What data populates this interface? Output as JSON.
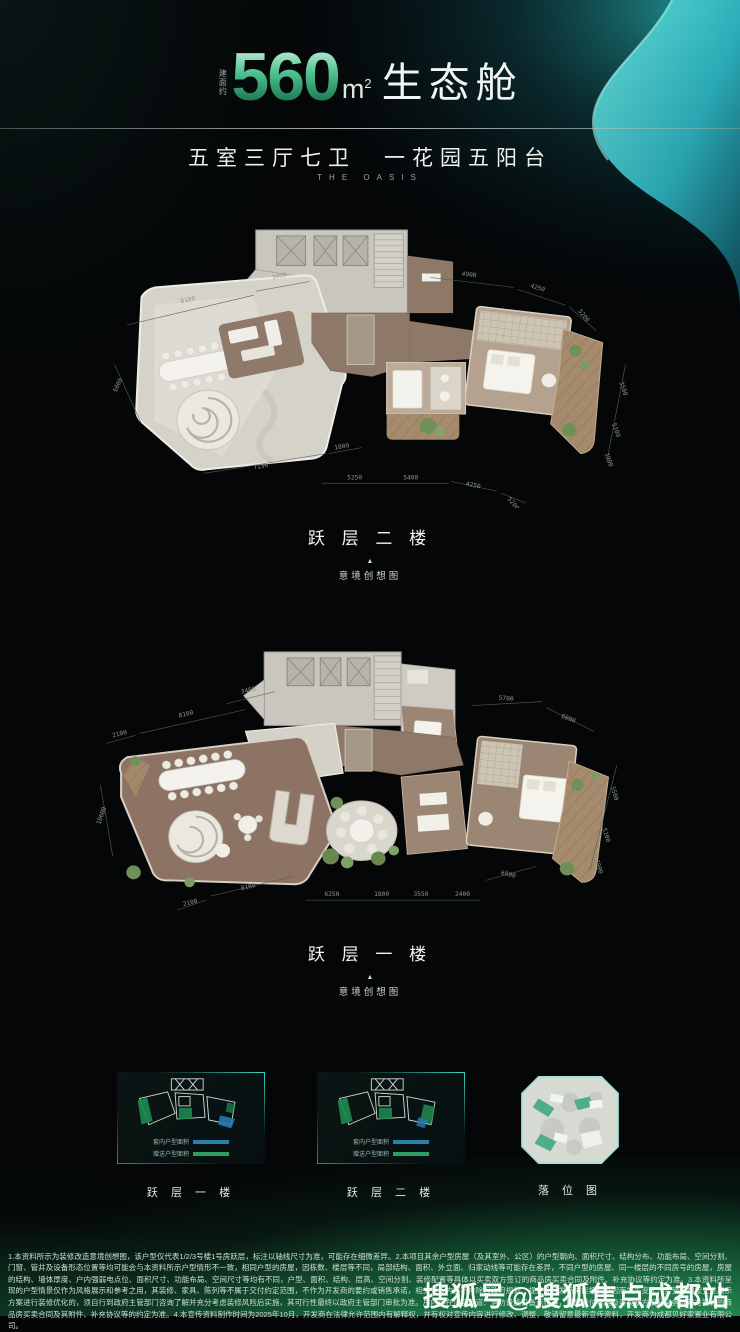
{
  "header": {
    "area_prefix": "建面约",
    "area_value": "560",
    "area_unit": "m",
    "area_exponent": "2",
    "title_suffix": "生态舱",
    "subtitle": "五室三厅七卫　一花园五阳台",
    "subtitle_en": "THE OASIS"
  },
  "colors": {
    "accent_green": "#2f9e6e",
    "wave_teal": "#3ed3cf",
    "legend_blue": "#2b7fa9",
    "legend_green": "#2f9e63",
    "footer_green": "#1f8a52"
  },
  "plans": {
    "upper": {
      "label": "跃 层 二 楼",
      "caption_marker": "▲",
      "caption": "意境创想图",
      "dims": [
        "8100",
        "3400",
        "4900",
        "4250",
        "5200",
        "6000",
        "7150",
        "1800",
        "5250",
        "5400",
        "4250",
        "5200",
        "3500",
        "5100",
        "1900"
      ]
    },
    "lower": {
      "label": "跃 层 一 楼",
      "caption_marker": "▲",
      "caption": "意境创想图",
      "dims": [
        "2100",
        "8100",
        "3400",
        "5700",
        "6000",
        "10600",
        "2100",
        "8100",
        "6250",
        "1800",
        "3550",
        "2400",
        "6000",
        "5500",
        "5100",
        "1900"
      ]
    }
  },
  "thumbnails": {
    "first": {
      "label": "跃 层 一 楼",
      "legend": [
        {
          "label": "套内户型面积",
          "color": "#2b7fa9"
        },
        {
          "label": "赠送户型面积",
          "color": "#2f9e63"
        }
      ]
    },
    "second": {
      "label": "跃 层 二 楼",
      "legend": [
        {
          "label": "套内户型面积",
          "color": "#2b7fa9"
        },
        {
          "label": "赠送户型面积",
          "color": "#2f9e63"
        }
      ]
    },
    "site": {
      "label": "落 位 图"
    }
  },
  "footer": {
    "disclaimer": "1.本资料所示为装修改造意境创想图，该户型仅代表1/2/3号楼1号房跃层，标注以轴线尺寸为准，可能存在细微差异。2.本项目其余户型房屋（及其室外、公区）的户型朝向、面积尺寸、结构分布、功能布局、空间分割、门窗、管井及设备形态位置等均可能会与本资料所示户型情形不一致，相同户型的房屋，因栋数、楼层等不同，局部结构、面积、外立面、归家动线等可能存在差异，不同户型的房屋、同一楼层的不同房号的房屋，房屋的结构、墙体厚度、户内强弱电点位、面积尺寸、功能布局、空间尺寸等均有不同，户型、面积、结构、层高、空间分割、装修配置等具体以买卖双方签订的商品房买卖合同及附件、补充协议等约定为准。3.本资料所呈现的户型情景仅作为风格展示和参考之用，其装修、家具、陈列等不属于交付约定范围，不作为开发商的要约或销售承诺，相关宣传内容不排除因政府规划、规定及开发商未能控制原因而发生变化，买受人如按上述展示方案进行装修优化的，须自行到政府主管部门咨询了解并充分考虑装修风险后实施，其可行性最终以政府主管部门审批为准。户内存在顶装管道、消防设施设备点位等，房屋交付标准及买卖双方权利义务以双方签订的商品房买卖合同及其附件、补充协议等的约定为准。4.本宣传资料制作时间为2025年10月，开发商在法律允许范围内有解释权，并有权对宣传内容进行修改、调整，敬请留意最新宣传资料，开发商为成都贝好家置业有限公司。",
    "watermark": "搜狐号@搜狐焦点成都站"
  }
}
